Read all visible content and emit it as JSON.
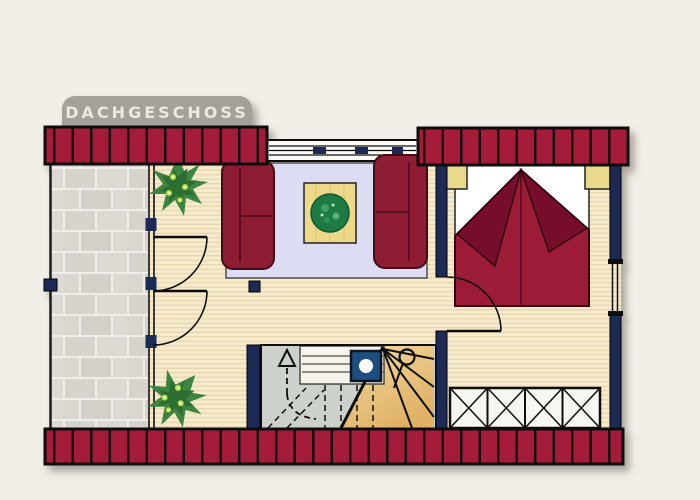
{
  "banner": {
    "label": "DACHGESCHOSS"
  },
  "palette": {
    "background": "#f2efe8",
    "banner_gray": "#a6a198",
    "wall_red": "#a51f3a",
    "wall_red_stripe": "#170a10",
    "wall_navy": "#1e2a54",
    "floor_wood": "#f5e9cb",
    "terrace_stone": "#d8d6cf",
    "rug_lavender": "#dcddf2",
    "sofa_red": "#8e1c33",
    "bed_blanket_red": "#9c1d38",
    "bed_fold_dark": "#76102a",
    "table_yellow": "#ecd98a",
    "bowl_green": "#1c7a42",
    "stair_gray": "#cdd1cb",
    "stair_winder_tan": "#eac885",
    "skylight_blue": "#1d4f80",
    "plant_green": "#3c8540",
    "outline_black": "#111111"
  },
  "elements": {
    "rooms": [
      "terrace",
      "living-area",
      "bedroom",
      "stair-hall"
    ],
    "furniture": [
      "sofa-left",
      "sofa-right",
      "coffee-table",
      "double-bed",
      "nightstand-left",
      "nightstand-right",
      "wardrobe"
    ],
    "features": [
      "winder-staircase",
      "stair-up-arrow",
      "skylight",
      "roof-edge-wall-top-left",
      "roof-edge-wall-top-right",
      "roof-edge-wall-bottom",
      "ridge-window",
      "terrace-glazing",
      "terrace-door-upper",
      "terrace-door-lower",
      "bedroom-door",
      "potted-plant-top",
      "potted-plant-bottom"
    ]
  }
}
